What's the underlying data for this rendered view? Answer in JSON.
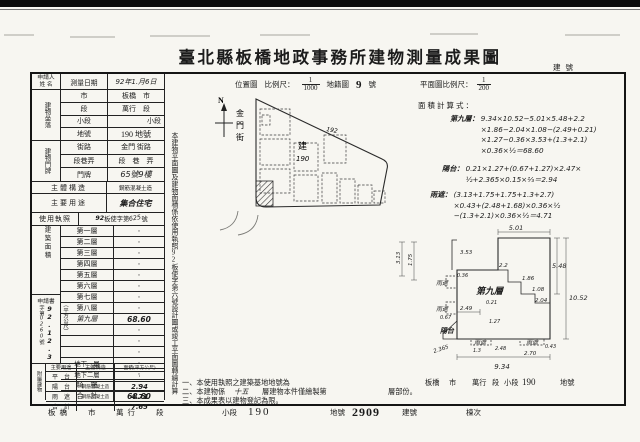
{
  "page": {
    "title": "臺北縣板橋地政事務所建物測量成果圖",
    "building_no_label": "建號"
  },
  "form": {
    "applicant_label": "申請人\n姓 名",
    "survey_label": "測量日期",
    "survey_value": "92年1.月6日",
    "location_group": "建物坐落",
    "location_rows": [
      {
        "label": "市",
        "value": "板橋　市"
      },
      {
        "label": "段",
        "value": "萬行　段"
      },
      {
        "label": "小段",
        "value": "小段"
      },
      {
        "label": "地號",
        "value": "190 地號"
      }
    ],
    "door_group": "建物門牌",
    "door_rows": [
      {
        "label": "街路",
        "value": "金門 街路"
      },
      {
        "label": "段巷弄",
        "value": "段　巷　弄"
      },
      {
        "label": "門牌",
        "value": "65號9樓"
      }
    ],
    "structure_label": "主體構造",
    "structure_value": "鋼筋混凝土造",
    "usage_label": "主要用途",
    "usage_value": "集合住宅",
    "license_label": "使用執照",
    "license_hw1": "92",
    "license_mid": "板使字第",
    "license_hw2": "625",
    "license_suffix": "號",
    "area_group": "建築面積",
    "area_unit": "（平方公尺）",
    "floor_rows": [
      {
        "label": "第一層",
        "value": "·"
      },
      {
        "label": "第二層",
        "value": "·"
      },
      {
        "label": "第三層",
        "value": "·"
      },
      {
        "label": "第四層",
        "value": "·"
      },
      {
        "label": "第五層",
        "value": "·"
      },
      {
        "label": "第六層",
        "value": "·"
      },
      {
        "label": "第七層",
        "value": "·"
      },
      {
        "label": "第八層",
        "value": "·"
      },
      {
        "label": "第九層",
        "value": "68.60"
      },
      {
        "label": "",
        "value": "·"
      },
      {
        "label": "",
        "value": "·"
      },
      {
        "label": "",
        "value": "·"
      },
      {
        "label": "地下一層",
        "value": "·"
      },
      {
        "label": "地下二層",
        "value": "·"
      },
      {
        "label": "騎　樓",
        "value": "·"
      },
      {
        "label": "合　計",
        "value": "68.60"
      }
    ],
    "application": {
      "title": "申請書",
      "field_prefix": "字第",
      "field_no": "0260",
      "field_suffix": "號",
      "date": "92.12.3"
    },
    "annex_group": "附屬建物",
    "annex_headers": [
      "主要用途",
      "主體構造",
      "面積(平方公尺)"
    ],
    "annex_rows": [
      {
        "usage": "平　台",
        "structure": "",
        "area": "·"
      },
      {
        "usage": "陽　台",
        "structure": "鋼筋混凝土造",
        "area": "2.94"
      },
      {
        "usage": "雨　遮",
        "structure": "鋼筋混凝土造",
        "area": "4.71"
      },
      {
        "usage": "合　計",
        "structure": "",
        "area": "7.65"
      }
    ]
  },
  "side_note": "本建物平面圖及建物面積係依使用執照92板使字第六號設計圖或竣工平面圖轉繪計算",
  "map": {
    "section_label": "位置圖",
    "scale_label": "比例尺：",
    "scale_num": "1",
    "scale_den": "1000",
    "sheet_label": "地籍圖",
    "sheet_no": "9",
    "sheet_suffix": "號",
    "north_label": "N",
    "street_name": "金門街",
    "lot_prefix": "建",
    "lot_no": "190",
    "adjacent_lot_no": "192"
  },
  "plan": {
    "scale_label": "平面圖比例尺：",
    "scale_num": "1",
    "scale_den": "200",
    "calc_title": "面積計算式：",
    "calc": [
      {
        "label": "第九層：",
        "body": "9.34×10.52−5.01×5.48+2.2\n×1.86−2.04×1.08−(2.49+0.21)\n×1.27−0.36×3.53+(1.3+2.1)\n×0.36×½＝68.60"
      },
      {
        "label": "陽台：",
        "body": "0.21×1.27+(0.67+1.27)×2.47×\n½+2.365×0.15×⅔＝2.94"
      },
      {
        "label": "雨遮：",
        "body": "(3.13+1.75+1.75+1.3+2.7)\n×0.43+(2.48+1.68)×0.36×½\n−(1.3+2.1)×0.36×½＝4.71"
      }
    ],
    "floor_label": "第九層",
    "balcony_label": "陽台",
    "canopy_label": "雨遮",
    "dims": {
      "top": "5.01",
      "right_upper": "5.48",
      "right_total": "10.52",
      "bottom": "9.34",
      "s22": "2.2",
      "s186": "1.86",
      "s108": "1.08",
      "s204": "2.04",
      "s353": "3.53",
      "s036": "0.36",
      "s313": "3.13",
      "s175": "1.75",
      "s249": "2.49",
      "s021": "0.21",
      "s127": "1.27",
      "s067": "0.67",
      "s2365": "2.365",
      "s13": "1.3",
      "s248": "2.48",
      "s270": "2.70",
      "s043": "0.43"
    }
  },
  "notes": {
    "n1_pre": "一、本使用執照之建築基地地號為",
    "n1_city": "板橋",
    "n1_city_suffix": "市",
    "n1_section": "萬行",
    "n1_section_suffix": "段",
    "n1_subsection": "小段",
    "n1_lot": "190",
    "n1_lot_suffix": "地號",
    "n2_pre": "二、本建物係",
    "n2_floors": "十五",
    "n2_mid": "層建物本件僅繪製第",
    "n2_suffix": "層部份。",
    "n3": "三、本成果表以建物登記為限。"
  },
  "footer": {
    "city": "板橋",
    "city_suffix": "市",
    "section": "萬行",
    "section_suffix": "段",
    "subsection_label": "小段",
    "subsection_no": "190",
    "lot_label": "地號",
    "lot_no": "2909",
    "building_label": "建號",
    "unit_label": "棟次"
  }
}
